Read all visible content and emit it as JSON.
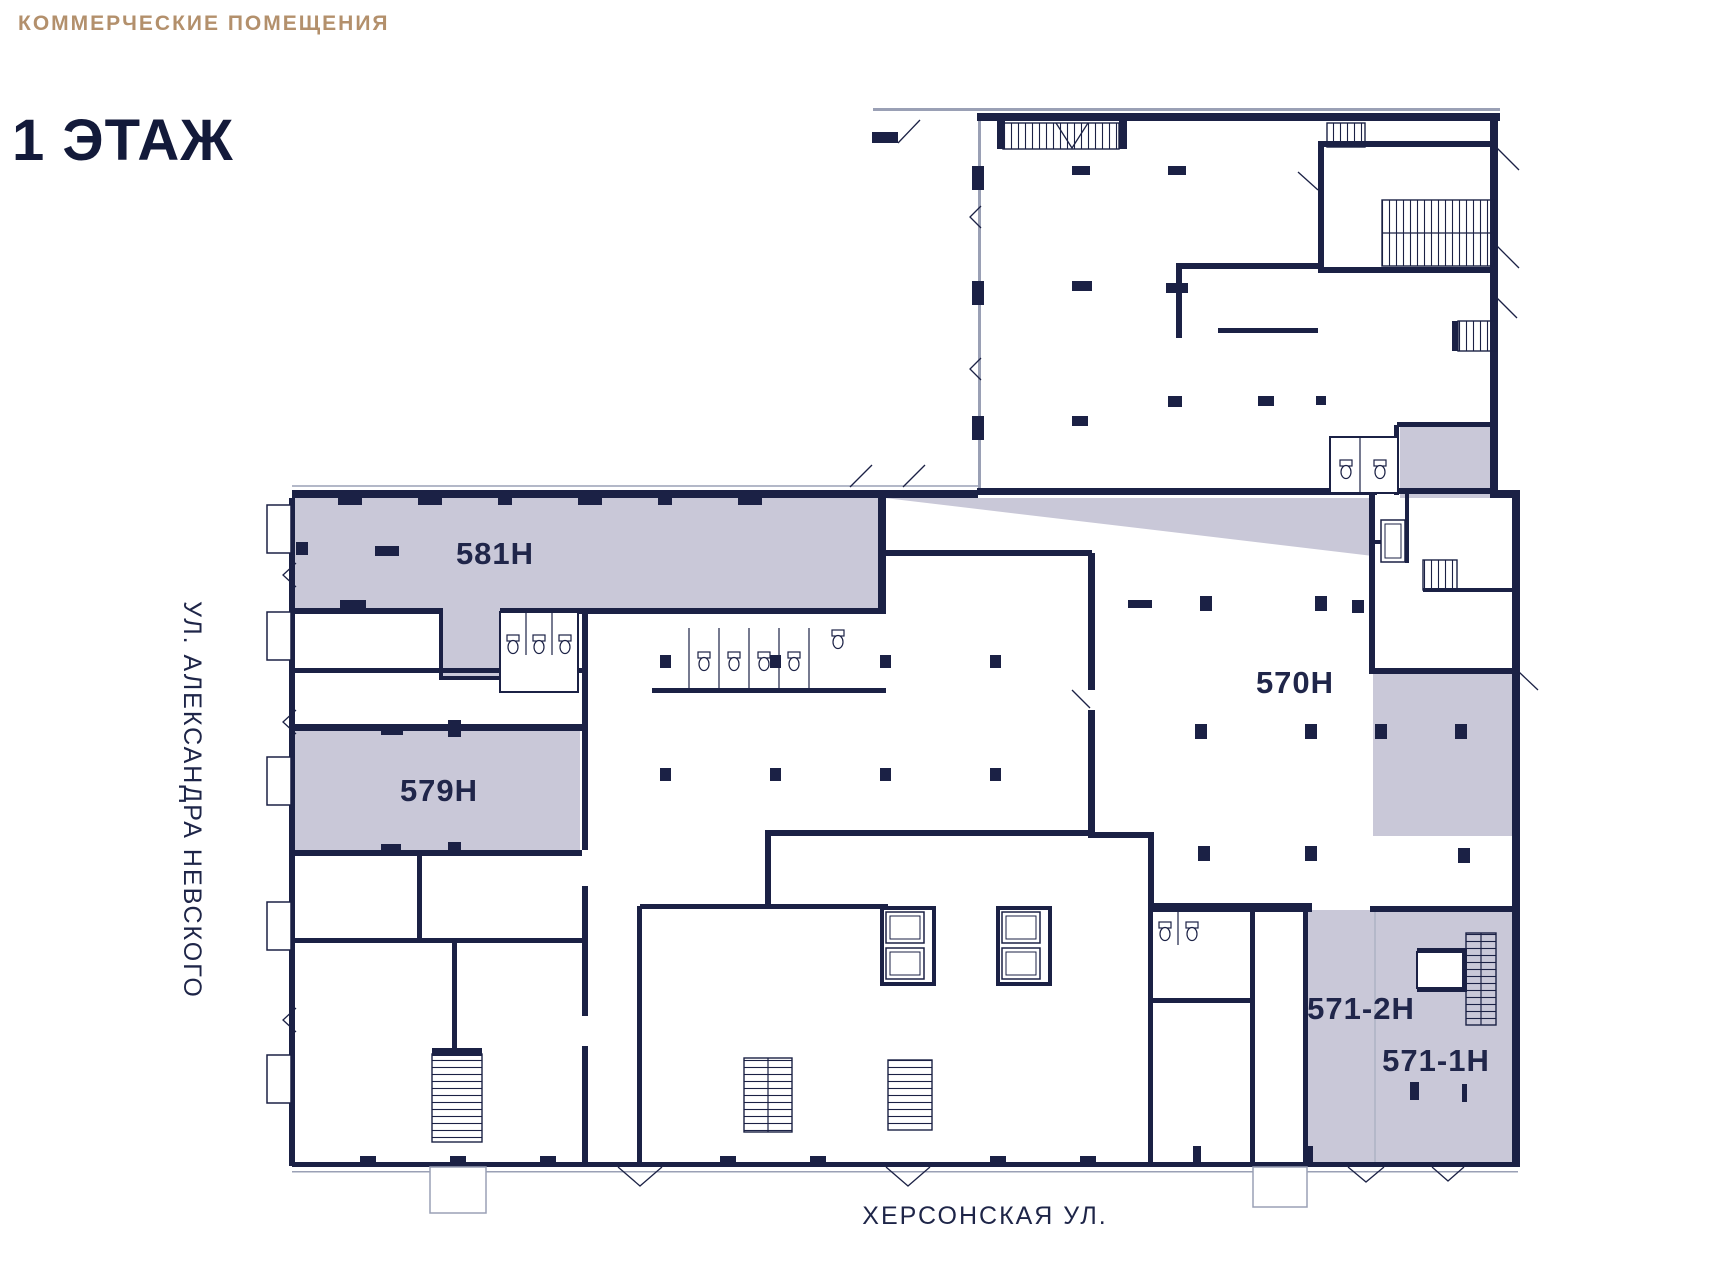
{
  "header": {
    "kicker": "КОММЕРЧЕСКИЕ ПОМЕЩЕНИЯ",
    "title": "1 ЭТАЖ"
  },
  "streets": {
    "left": "УЛ. АЛЕКСАНДРА НЕВСКОГО",
    "bottom": "ХЕРСОНСКАЯ УЛ."
  },
  "floor_plan": {
    "floor_number": "1",
    "units": [
      {
        "label": "581Н"
      },
      {
        "label": "579Н"
      },
      {
        "label": "570Н"
      },
      {
        "label": "571-2Н"
      },
      {
        "label": "571-1Н"
      }
    ],
    "colors": {
      "highlight": "#c9c8d8",
      "walls": "#1b2145",
      "kicker_accent": "#b3906c",
      "title_navy": "#131a3a"
    }
  }
}
